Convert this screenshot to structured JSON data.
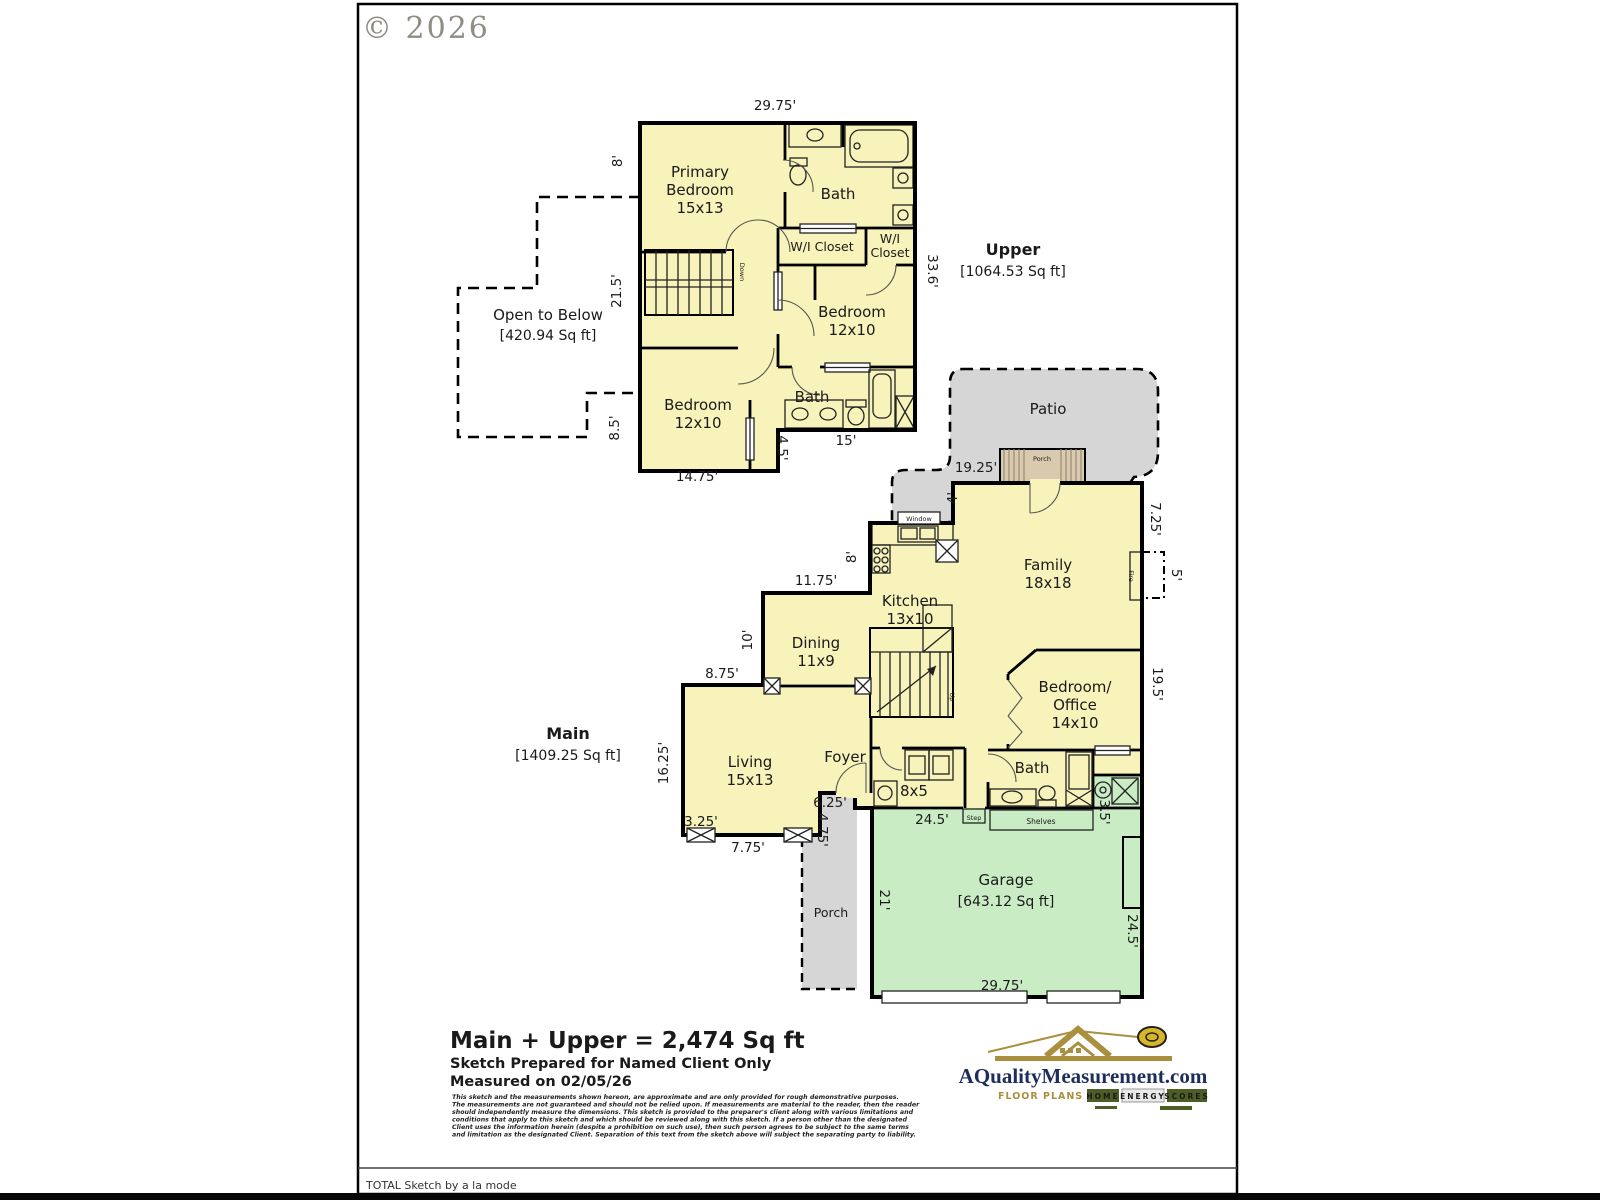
{
  "copyright": "© 2026",
  "upper": {
    "floor": [
      "Upper",
      "[1064.53 Sq ft]"
    ],
    "open_below": [
      "Open to Below",
      "[420.94 Sq ft]"
    ],
    "rooms": {
      "primary": [
        "Primary",
        "Bedroom",
        "15x13"
      ],
      "bath_top": "Bath",
      "wic_left": "W/I Closet",
      "wic_right": [
        "W/I",
        "Closet"
      ],
      "bedroom_mid": [
        "Bedroom",
        "12x10"
      ],
      "bedroom_low": [
        "Bedroom",
        "12x10"
      ],
      "bath_low": "Bath",
      "stairs": "Down"
    },
    "dims": {
      "top": "29.75'",
      "left_a": "8'",
      "left_b": "21.5'",
      "left_c": "8.5'",
      "right": "33.6'",
      "bath_w": "15'",
      "bath_h": "4.5'",
      "bottom": "14.75'"
    }
  },
  "main": {
    "floor": [
      "Main",
      "[1409.25 Sq ft]"
    ],
    "rooms": {
      "family": [
        "Family",
        "18x18"
      ],
      "kitchen": [
        "Kitchen",
        "13x10"
      ],
      "dining": [
        "Dining",
        "11x9"
      ],
      "living": [
        "Living",
        "15x13"
      ],
      "foyer": "Foyer",
      "laundry": "8x5",
      "bath": "Bath",
      "bedroom_office": [
        "Bedroom/",
        "Office",
        "14x10"
      ],
      "garage": [
        "Garage",
        "[643.12 Sq ft]"
      ],
      "stairs": "Up"
    },
    "areas": {
      "patio": "Patio",
      "porch_top": "Porch",
      "porch_front": "Porch"
    },
    "fixtures": {
      "window": "Window",
      "fire": "Fire",
      "step": "Step",
      "shelves": "Shelves"
    },
    "dims": {
      "patio_w": "19.25'",
      "porch_d": "4'",
      "kitchen_l": "8'",
      "dining_t": "11.75'",
      "dining_l": "10'",
      "living_t": "8.75'",
      "living_l": "16.25'",
      "living_ba": "3.25'",
      "living_bb": "7.75'",
      "porch_w": "6.25'",
      "porch_h": "4.75'",
      "garage_t": "24.5'",
      "garage_l": "21'",
      "garage_b": "29.75'",
      "garage_r": "24.5'",
      "notch": "3.5'",
      "right_a": "19.5'",
      "right_b": "7.25'",
      "fire_w": "5'"
    }
  },
  "footer": {
    "total": "Main + Upper = 2,474 Sq ft",
    "prepared": "Sketch Prepared for Named Client Only",
    "measured": "Measured on 02/05/26",
    "disclaimer": [
      "This sketch and the measurements shown hereon, are approximate and are only provided for rough demonstrative purposes.",
      "The measurements are not guaranteed and should not be relied upon.  If measurements are material to the reader, then the reader",
      "should independently measure the dimensions.  This sketch is provided to the preparer's client along with various limitations and",
      "conditions that apply to this sketch and which should be reviewed along with this sketch.  If a person other than the designated",
      "Client uses the information herein (despite a prohibition on such use), then such person agrees to be subject to the same terms",
      "and limitation as the designated Client.  Separation of this text from the sketch above will subject the separating party to liability."
    ],
    "app_credit": "TOTAL Sketch by a la mode"
  },
  "logo": {
    "domain": "AQualityMeasurement.com",
    "tagline": "FLOOR PLANS &",
    "badges": [
      "HOME",
      "ENERGY",
      "SCORES"
    ]
  },
  "colors": {
    "room_fill": "#f7f3ba",
    "garage_fill": "#c9ecc4",
    "patio_fill": "#d6d6d6",
    "porch_fill": "#d9c9ae",
    "wall": "#000000",
    "logo_gold": "#a98f3e",
    "logo_navy": "#1d2d5c",
    "badge_green": "#4c5e26"
  }
}
